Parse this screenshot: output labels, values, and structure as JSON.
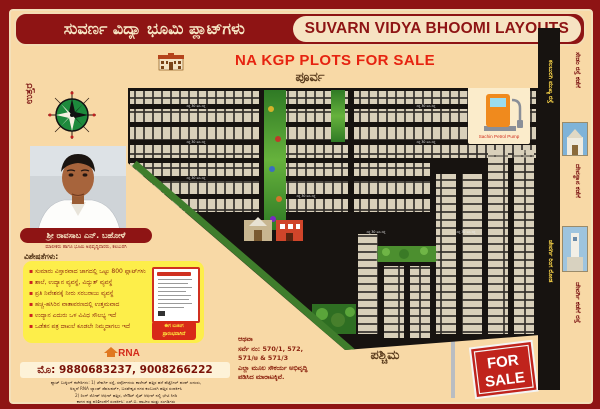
{
  "header": {
    "title_kannada": "ಸುವರ್ಣ ವಿದ್ಯಾ ಭೂಮಿ ಪ್ಲಾಟ್‌ಗಳು",
    "title_english": "SUVARN VIDYA BHOOMI LAYOUTS"
  },
  "banner": {
    "sale_text": "NA KGP PLOTS FOR SALE"
  },
  "directions": {
    "north": "ಉತ್ತರ",
    "east": "ಪೂರ್ವ",
    "west": "ಪಶ್ಚಿಮ"
  },
  "person": {
    "name": "ಶ್ರೀ ರಾವಸಾಬ ಎನ್. ಬಹೋಳೆ",
    "designation": "ಮಾಲೀಕರು ಹಾಗೂ ಭೂಮಿ ಅಭಿವೃದ್ಧಿದಾರರು, ಕಲಬುರಗಿ"
  },
  "features": {
    "heading": "ವಿಶೇಷತೆಗಳು:",
    "items": [
      "ಸುಮಾರು ವಿಸ್ತಾರವಾದ ಜಾಗದಲ್ಲಿ ಒಟ್ಟು 800 ಪ್ಲಾಟ್‌ಗಳು",
      "ಶಾಲೆ, ಉದ್ಯಾನ ವ್ಯವಸ್ಥೆ, ವಿದ್ಯುತ್ ವ್ಯವಸ್ಥೆ",
      "ಪ್ರತಿ ನಿವೇಶನಕ್ಕೆ ನೀರು ಸರಬರಾಜು ವ್ಯವಸ್ಥೆ",
      "ಹಚ್ಚ-ಹಸಿರಿನ ವಾತಾವರಣದಲ್ಲಿ ಉತ್ತಮವಾದ",
      "ಉದ್ಯಾನ ಎದುರು ಒಳ ವಿವಿಧ ಸೌಲಭ್ಯ ಇದೆ",
      "ಒಡೆತನ ಪತ್ರ ದಾಖಲೆ ಕೂಡಲೇ ನಿಮ್ಮದಾಗಲು ಇದೆ"
    ],
    "booking_line1": "ಈಗ ಬುಕಿಂಗ",
    "booking_line2": "ಪ್ರಾರಂಭವಾಗಿದೆ"
  },
  "contact": {
    "logo_text": "RNA",
    "logo_tagline": "ಭೂಮಿ ಅಭಿವೃದ್ಧಿ ಸಂಸ್ಥೆ",
    "phone_line": "ಮೊ: 9880683237, 9008266222",
    "fine_print": [
      "ಪ್ಲಾಟ್ ಬುಕ್ಕಿಂಗ್ ಕಚೇರಿಗಳು: 1) ಜೇವರ್ಗಿ ರಸ್ತೆ, ಸರ್ವೋದಯ ಕಾಲೇಜ್ ಹತ್ತಿರ ಹಳೆ ಪೆಟ್ರೋಲ್ ಪಂಪ್ ಎದುರು,",
      "ಅಲ್ಲದೆ RNA ಲ್ಯಾಂಡ್ ಡೆವಲಪರ್ಸ್, ಬಸವೇಶ್ವರ ನಗರ ಕಲಬುರಗಿ ಹತ್ತಿರ ಸಂಪರ್ಕಿಸಿ",
      "2) ರಿಂಗ್ ರೋಡ್ ಆಫೀಸ್ ಹತ್ತಿರ, ಲೇಔಟ್ ಸೈಟ್ ಆಫೀಸ್ ನಲ್ಲಿ ಭೇಟಿ ನೀಡಿ",
      "ಕಾಗದ ಪತ್ರ ಪರಿಶೀಲನೆಗೆ ಸಂಪರ್ಕಿಸಿ: ಎಸ್.ಬಿ. ಪಾಟೀಲ ಮತ್ತು ಸಂಗಡಿಗರು"
    ]
  },
  "survey": {
    "lines": [
      "ಆಥವಾ",
      "ಸರ್ವೆ ನಂ: 570/1, 572,",
      "571/ಅ & 571/3",
      "ಎಲ್ಲಾ ಮೂಲ ಸೌಕರ್ಯ ಅಭಿವೃದ್ಧಿ",
      "ಪಡಿಸಿದ ಮಾರಾಟಕ್ಕಿವೆ."
    ]
  },
  "for_sale": {
    "word1": "FOR",
    "word2": "SALE"
  },
  "map": {
    "road_label": "ರಸ್ತೆ 30 ಅಡಿ ರಸ್ತೆ",
    "petrol_pump_label": "Sachin Petrol Pump"
  },
  "road_strip": {
    "label_top": "ಕಲಬುರಗಿ ಮುಖ್ಯ ರಸ್ತೆ",
    "label_bottom": "ಜೇವರ್ಗಿ ರಿಂಗ ರೋಡ"
  },
  "right_column": {
    "label_top": "ಸೇಡಂ ರಸ್ತೆ ಕಡೆಗೆ",
    "label_mid": "ದೇವಸ್ಥಾನ ಕಡೆಗೆ",
    "label_bottom": "ಜೇವರ್ಗಿ ಕಡೆಗೆ ರಸ್ತೆ"
  },
  "colors": {
    "frame_red": "#8e1414",
    "cream": "#f8d9a6",
    "feature_yellow": "#fdee4a",
    "sale_red": "#e62310",
    "plot_tan": "#d9d0ba"
  }
}
